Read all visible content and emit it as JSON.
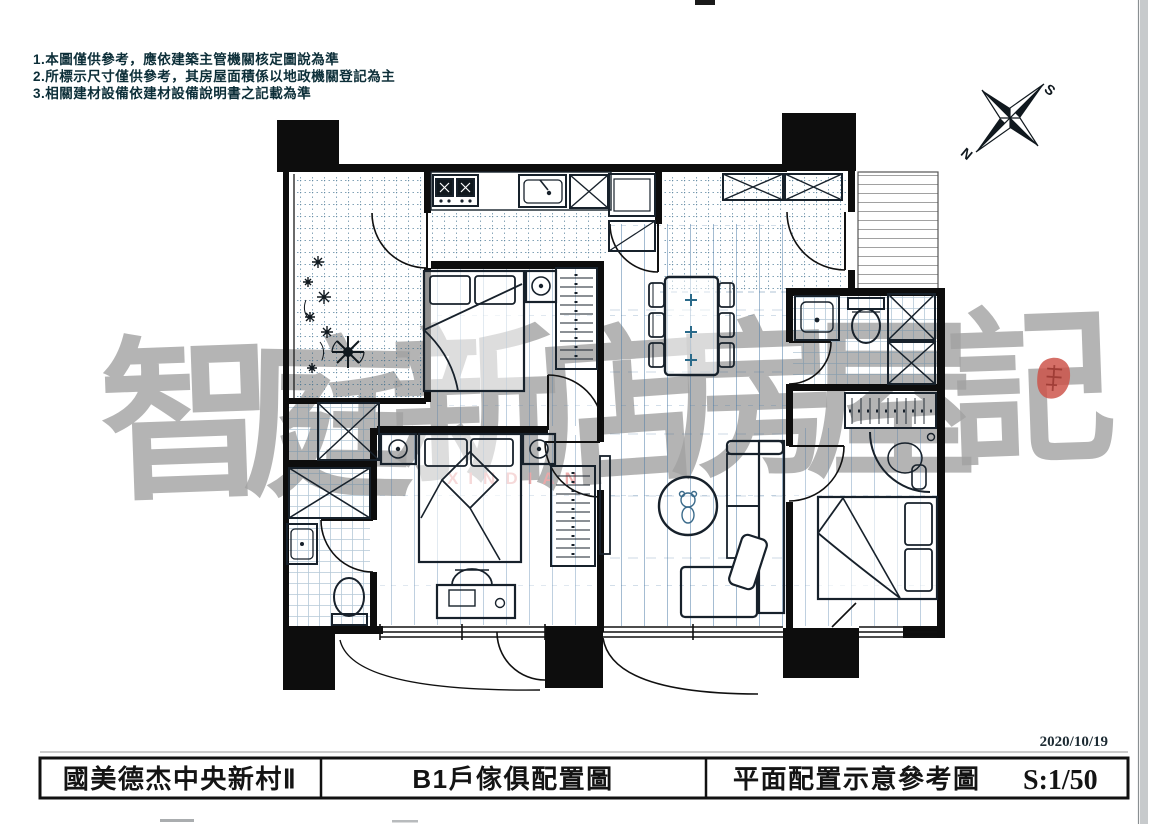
{
  "notes": {
    "line1": "1.本圖僅供參考，應依建築主管機關核定圖說為準",
    "line2": "2.所標示尺寸僅供參考，其房屋面積係以地政機關登記為主",
    "line3": "3.相關建材設備依建材設備說明書之記載為準"
  },
  "compass": {
    "south_label": "S",
    "north_label": "N"
  },
  "watermark": {
    "characters": [
      "智",
      "庭",
      "新",
      "店",
      "房",
      "屋",
      "記"
    ],
    "subtext": "XINDIAN",
    "color": "#a2a2a2",
    "seal_color": "#cc4f45"
  },
  "title_block": {
    "project_name": "國美德杰中央新村Ⅱ",
    "drawing_title": "B1戶傢俱配置圖",
    "drawing_type": "平面配置示意參考圖",
    "scale": "S:1/50",
    "date": "2020/10/19"
  }
}
